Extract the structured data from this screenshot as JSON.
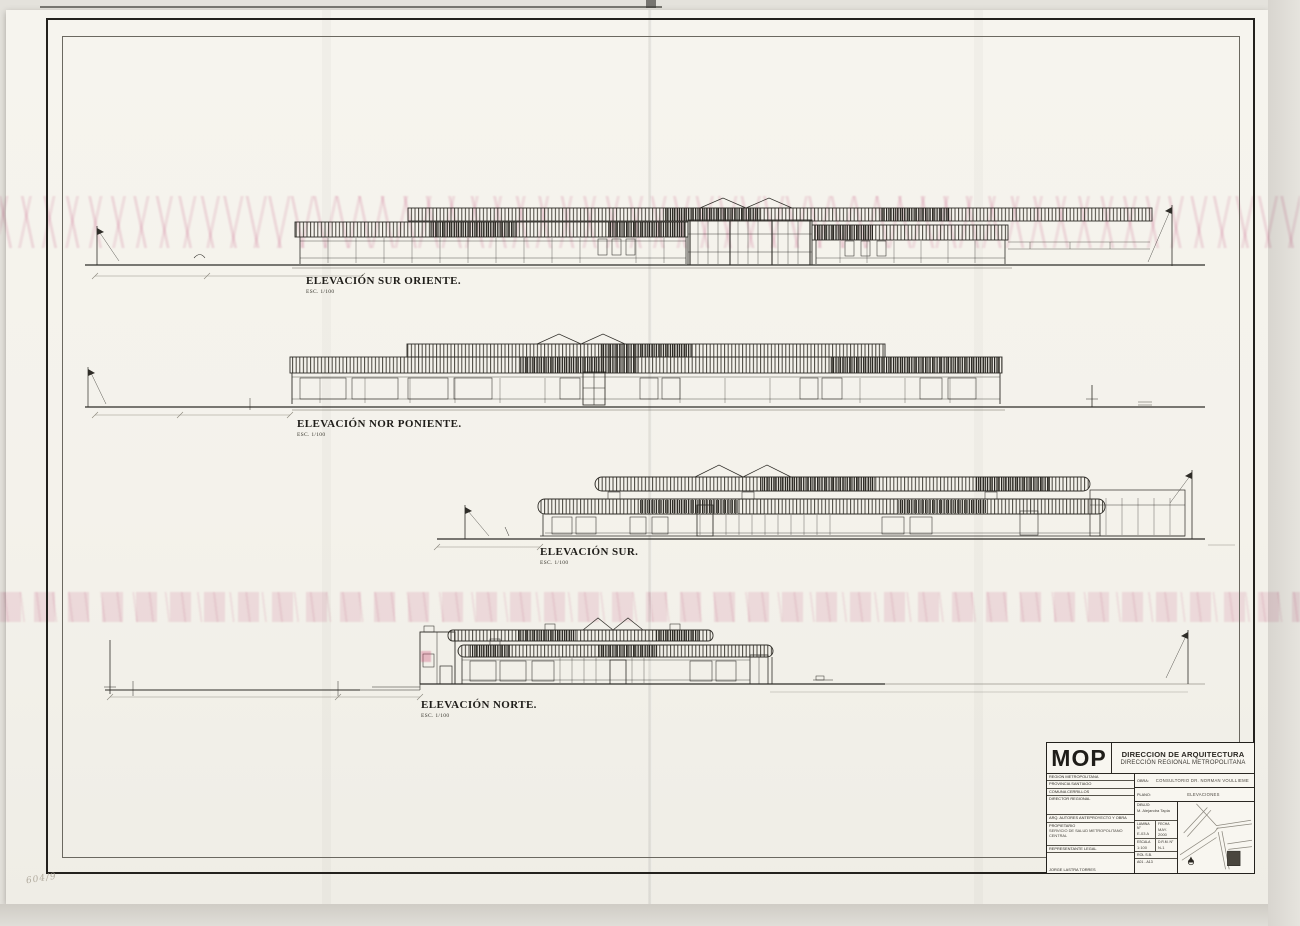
{
  "sheet": {
    "handwritten_note": "604/9"
  },
  "elevations": [
    {
      "name": "ELEVACIÓN SUR ORIENTE.",
      "scale": "ESC. 1/100"
    },
    {
      "name": "ELEVACIÓN NOR PONIENTE.",
      "scale": "ESC. 1/100"
    },
    {
      "name": "ELEVACIÓN SUR.",
      "scale": "ESC. 1/100"
    },
    {
      "name": "ELEVACIÓN NORTE.",
      "scale": "ESC. 1/100"
    }
  ],
  "title_block": {
    "logo": "MOP",
    "org1": "DIRECCION DE ARQUITECTURA",
    "org2": "DIRECCIÓN REGIONAL METROPOLITANA",
    "row_region": "REGION METROPOLITANA",
    "row_provincia": "PROVINCIA SANTIAGO",
    "row_comuna": "COMUNA CERRILLOS",
    "row_director": "DIRECTOR REGIONAL",
    "row_arq": "ARQ. AUTORES ANTEPROYECTO Y OBRA",
    "row_propietario": "PROPIETARIO",
    "row_propietario_value": "SERVICIO DE SALUD METROPOLITANO CENTRAL",
    "row_rep_legal": "REPRESENTANTE LEGAL",
    "row_rep_legal_value": "JORGE LASTRA TORRES",
    "obra_label": "OBRA:",
    "obra_value": "CONSULTORIO DR. NORMAN VOULLIEME",
    "plano_label": "PLANO:",
    "plano_value": "ELEVACIONES",
    "dibujo_label": "DIBUJO:",
    "dibujo_value": "M. Alejandra Tapia",
    "lamina_label": "LAMINA N°",
    "lamina_value": "E-03 A",
    "fecha_label": "FECHA",
    "fecha_value": "MAY. 2000",
    "escala_label": "ESCALA",
    "escala_value": "1:100",
    "drm_label": "D.R.M. N°",
    "drm_value": "N-1",
    "rol_label": "ROL S.B.",
    "rol_value": "A01 - A13"
  }
}
